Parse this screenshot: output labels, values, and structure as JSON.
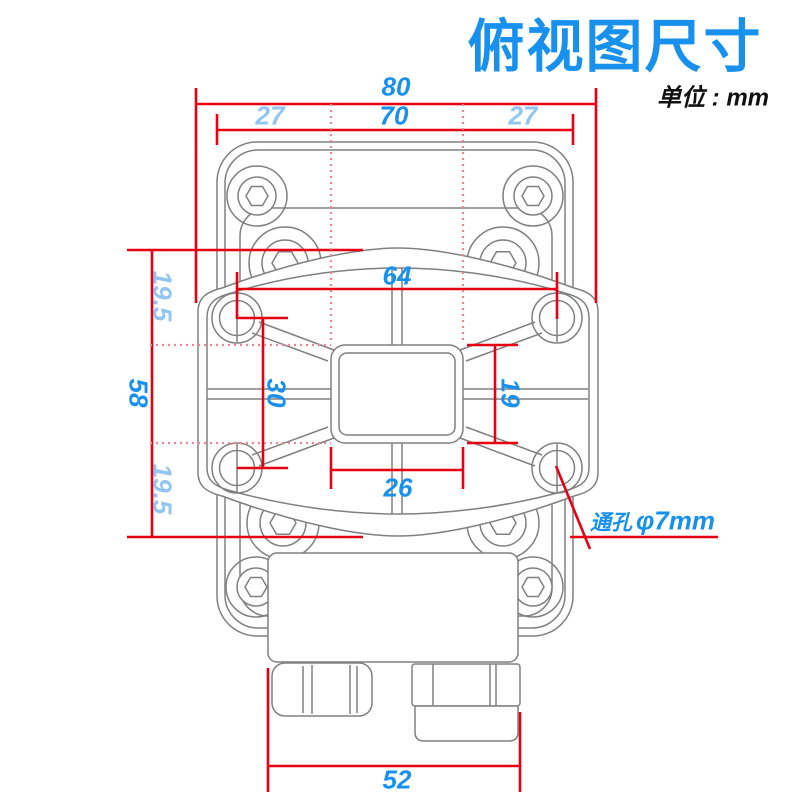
{
  "title": "俯视图尺寸",
  "unit_label": "单位 : mm",
  "dimensions": {
    "overall_width": "80",
    "plate_width": "70",
    "offset_left": "27",
    "offset_right": "27",
    "hole_span_horizontal": "64",
    "hole_span_vertical": "30",
    "overall_height": "58",
    "offset_top": "19.5",
    "offset_bottom": "19.5",
    "center_square_width": "26",
    "center_square_height": "19",
    "bottom_body_width": "52"
  },
  "annotation": {
    "through_hole_label": "通孔",
    "through_hole_size": "φ7mm"
  },
  "colors": {
    "accent_blue": "#1890ee",
    "light_blue": "#92c5f1",
    "dimension_red": "#e60012",
    "drawing_gray": "#808080",
    "dotted_pink": "#f0858f"
  }
}
